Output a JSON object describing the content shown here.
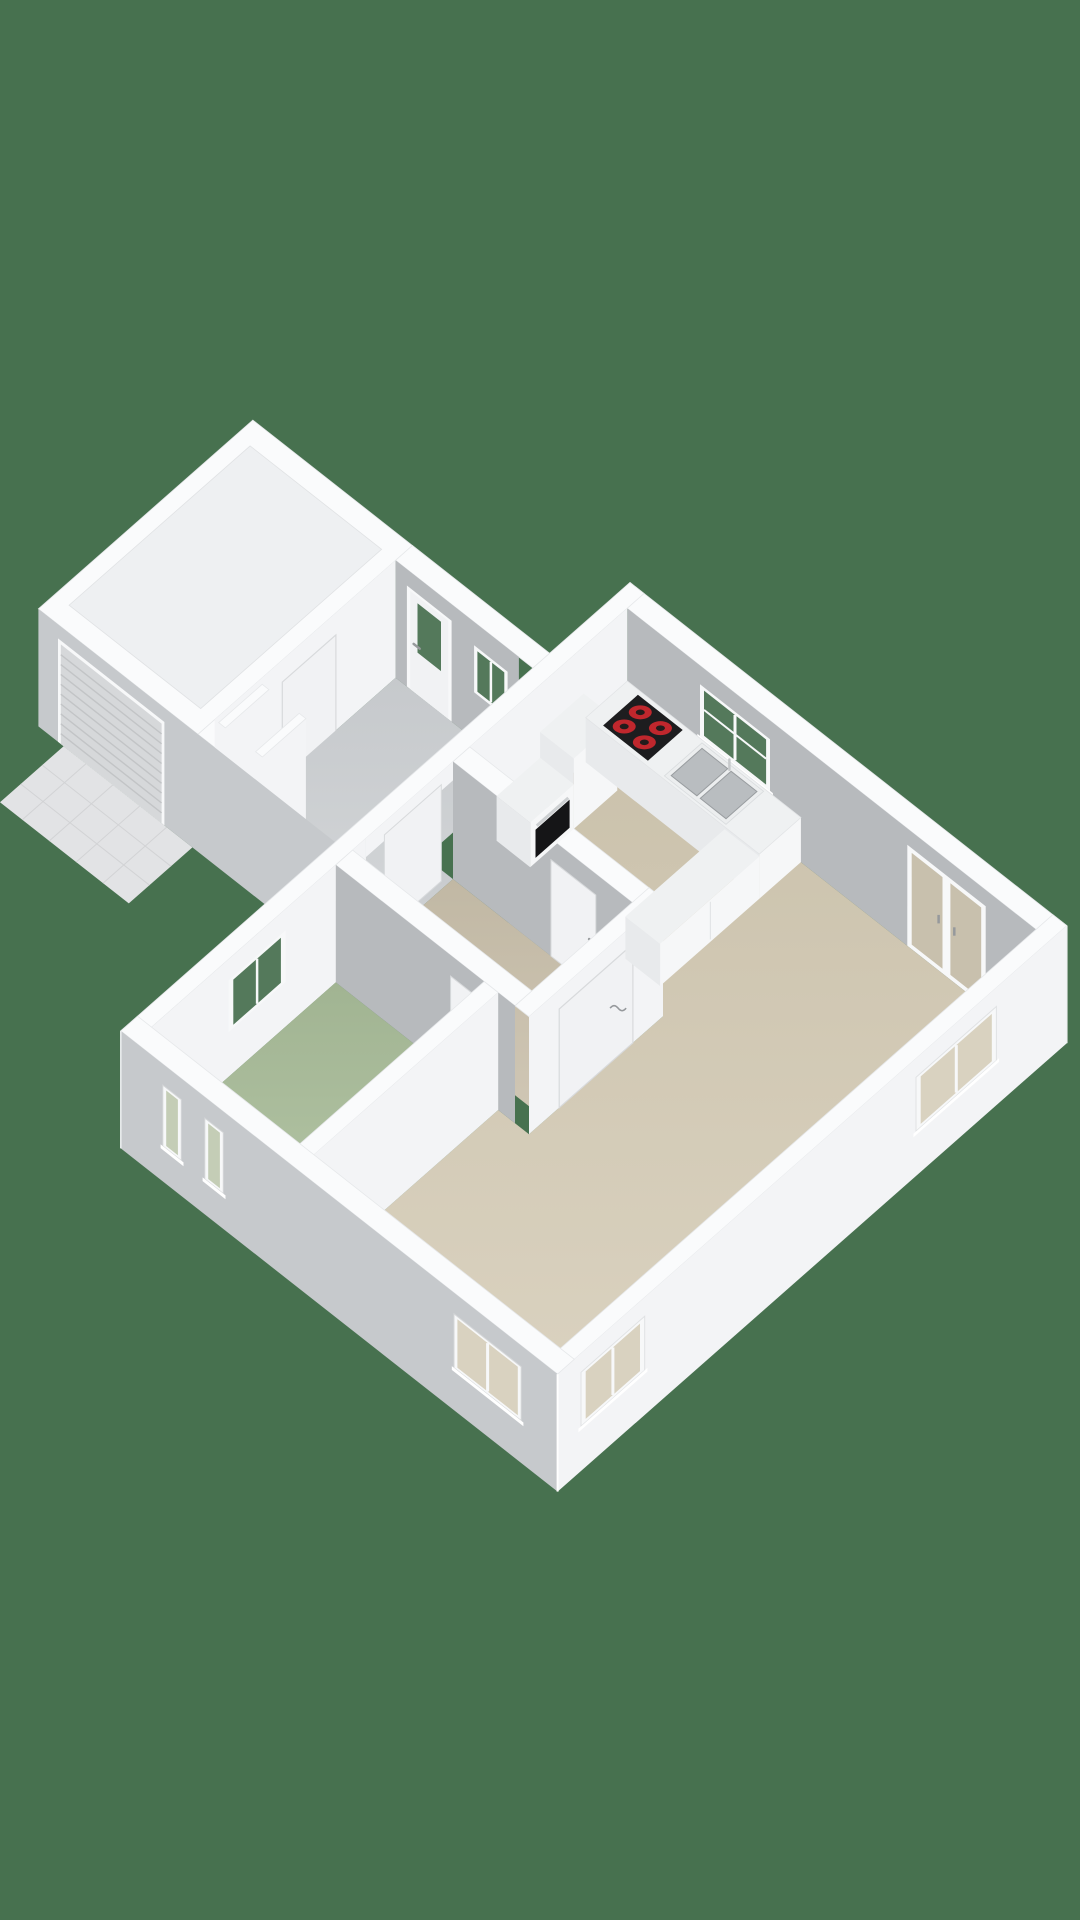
{
  "scene": {
    "title": "3d-floorplan-render",
    "view": "isometric-3d",
    "background_color": "#47714f",
    "rooms": [
      {
        "name": "garage",
        "roofed": true,
        "roof_color": "#eef0f2"
      },
      {
        "name": "utility-entry",
        "floor_colors": [
          "#c6c9cc",
          "#d3d6d8"
        ]
      },
      {
        "name": "hallway",
        "floor_colors": [
          "#c1b8a4",
          "#cfc6b4"
        ]
      },
      {
        "name": "bedroom",
        "floor_colors": [
          "#a1b492",
          "#b5c6a7"
        ]
      },
      {
        "name": "living-kitchen",
        "floor_colors": [
          "#cac1ab",
          "#dcd4c2"
        ]
      }
    ],
    "palette": {
      "wall_top": "#fafbfc",
      "wall_edge": "#e6e8ea",
      "face_light": "#f3f4f6",
      "face_shade_interior": "#b7babd",
      "face_shade_exterior": "#c6c9cc",
      "door_leaf": "#f1f2f4",
      "door_line": "#d8dadc",
      "handle": "#96999c",
      "glass_outside_green": "#54795b",
      "glass_tan": "#c8c0ad",
      "glass_interior_beige": "#d9d2c0",
      "glass_bedroom": "#c4cdb6",
      "frame_white": "#f7f8f9",
      "driveway": "#e2e3e5",
      "driveway_line": "#d2d3d5",
      "roller_door": "#d6d8da",
      "roller_line": "#c2c4c6",
      "counter_top": "#eff1f2",
      "counter_face": "#e8eaec",
      "box_face_light": "#f6f7f8",
      "sink_steel": "#b9bdc0",
      "sink_rim": "#eceeef",
      "sink_dark": "#999da0",
      "cooktop": "#1d1d1f",
      "burner_red": "#c0272d",
      "burner_core": "#231c1c",
      "oven_glass": "#151517",
      "oven_handle": "#cdd0d2",
      "rack_top": "#2e2f31",
      "rack_side": "#202123",
      "shoe_red": "#b0322e"
    },
    "fixtures": [
      "garage-roller-door",
      "driveway",
      "entrance-door",
      "entry-window",
      "shoe-rack",
      "kitchen-tall-cabinet",
      "kitchen-oven",
      "kitchen-cooktop",
      "kitchen-sink",
      "kitchen-counter",
      "kitchen-peninsula",
      "french-doors",
      "kitchen-window",
      "bedroom-west-window",
      "bedroom-south-windows",
      "living-south-window",
      "living-east-windows",
      "hall-door",
      "bedroom-door",
      "kitchen-hall-door",
      "living-hall-door"
    ]
  }
}
